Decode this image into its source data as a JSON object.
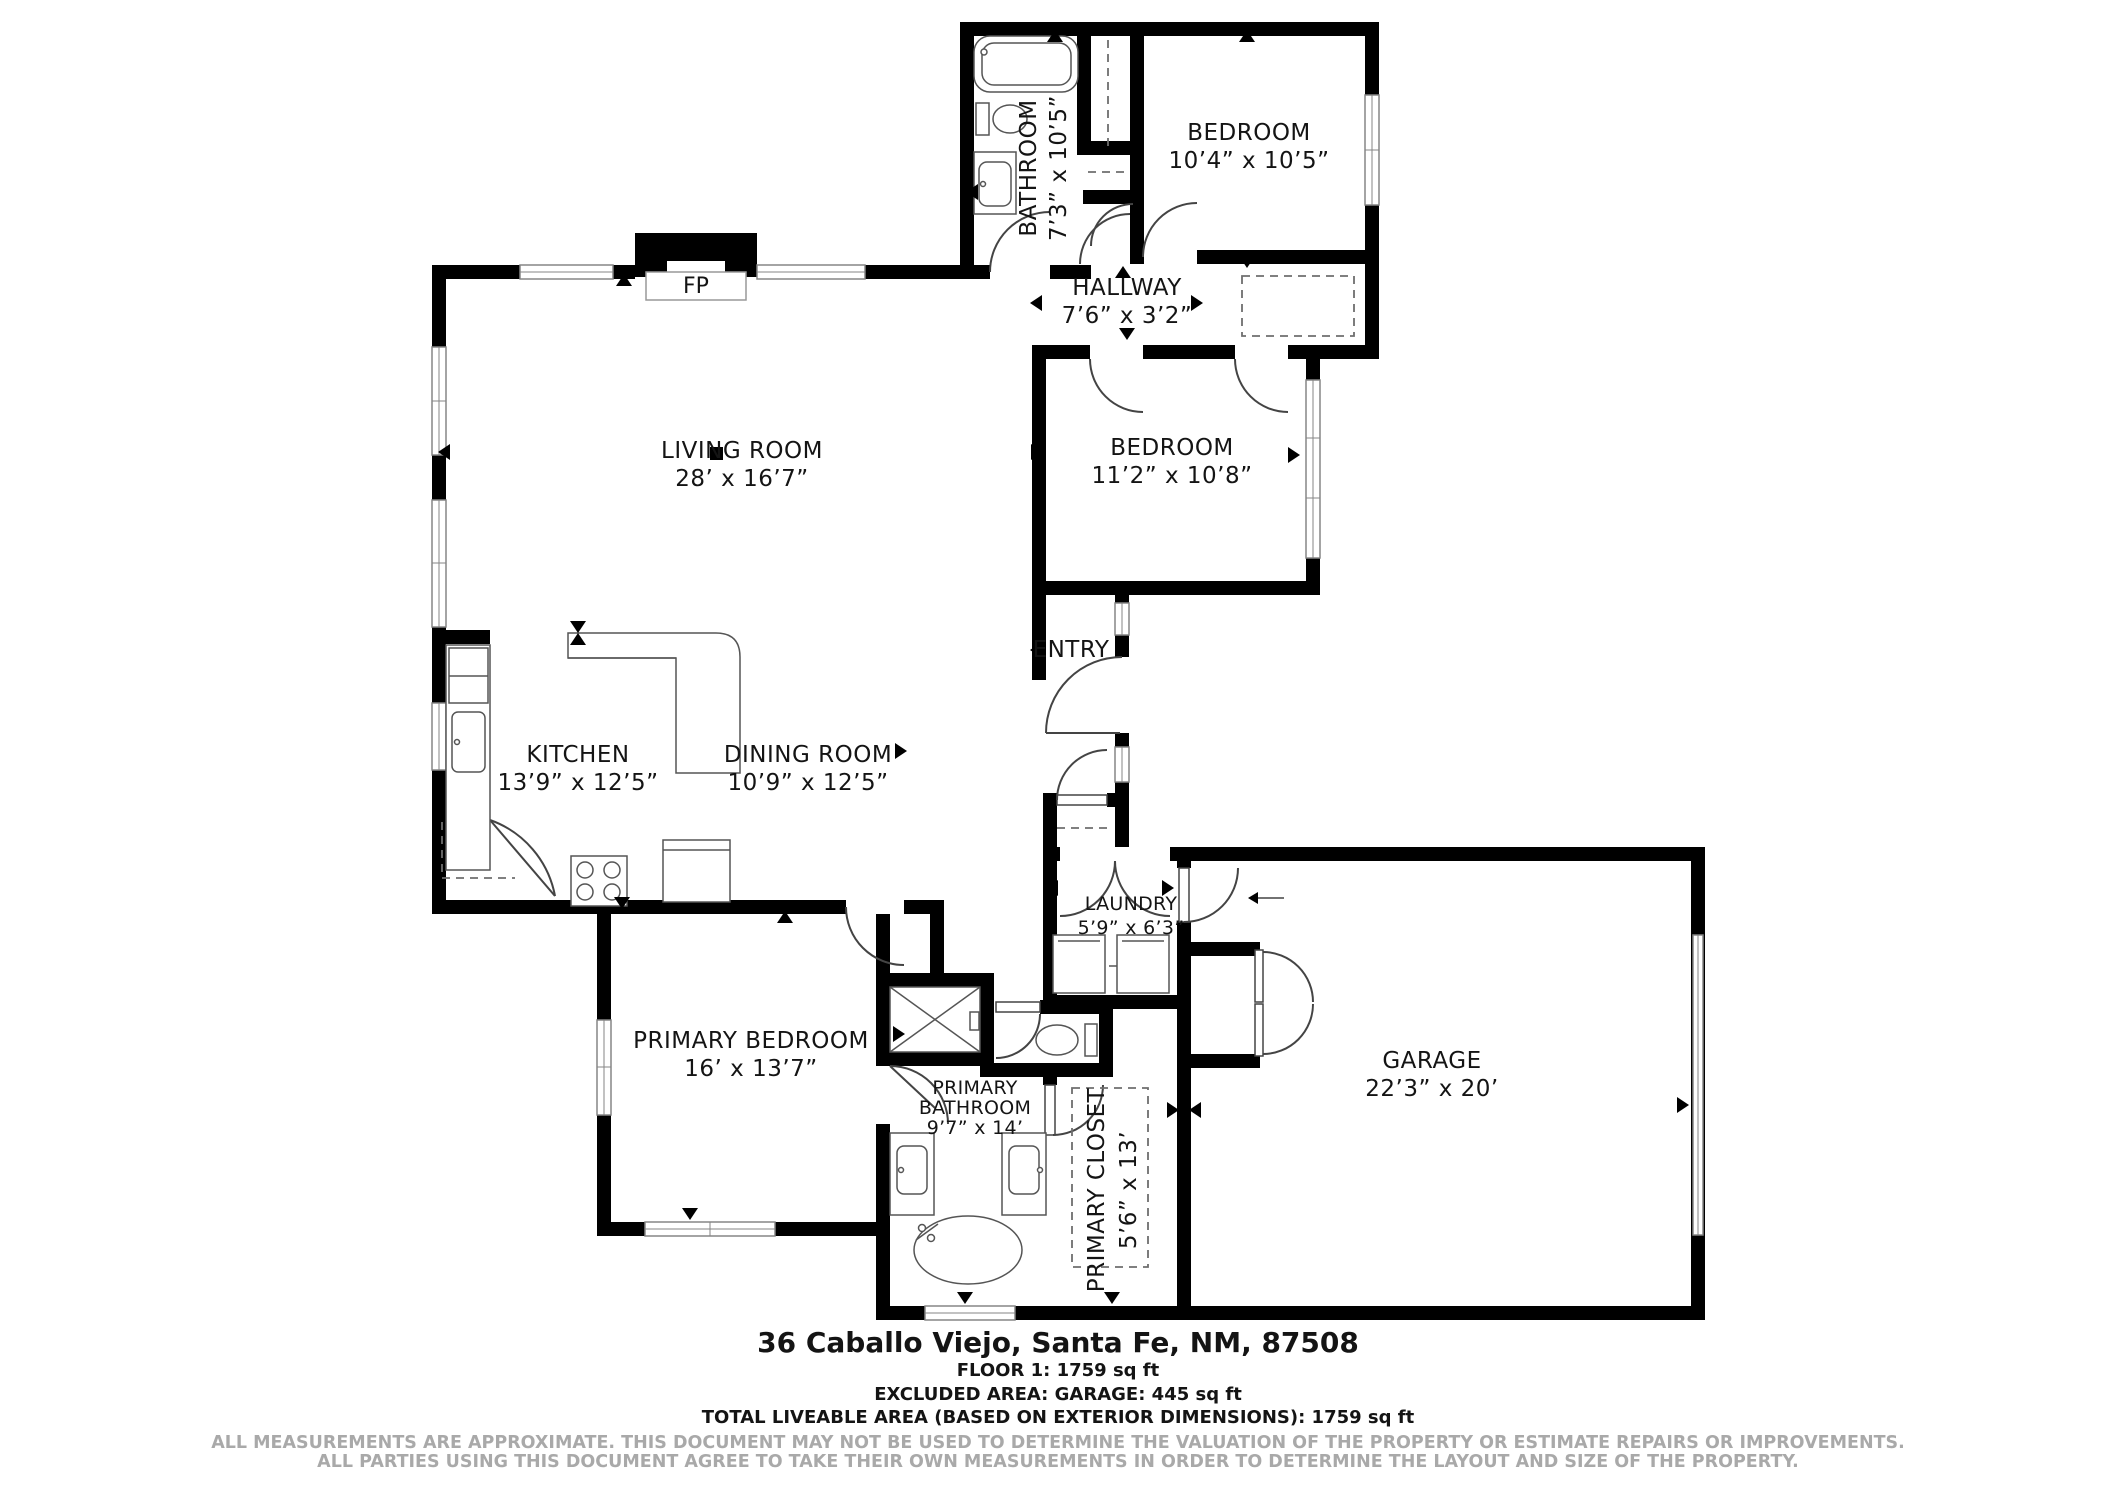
{
  "rooms": {
    "bathroom": {
      "name": "BATHROOM",
      "dims": "7’3” x 10’5”"
    },
    "bedroom_top": {
      "name": "BEDROOM",
      "dims": "10’4” x 10’5”"
    },
    "hallway": {
      "name": "HALLWAY",
      "dims": "7’6” x 3’2”"
    },
    "living_room": {
      "name": "LIVING ROOM",
      "dims": "28’ x 16’7”"
    },
    "bedroom_middle": {
      "name": "BEDROOM",
      "dims": "11’2” x 10’8”"
    },
    "entry": {
      "name": "ENTRY"
    },
    "kitchen": {
      "name": "KITCHEN",
      "dims": "13’9” x 12’5”"
    },
    "dining_room": {
      "name": "DINING ROOM",
      "dims": "10’9” x 12’5”"
    },
    "laundry": {
      "name": "LAUNDRY",
      "dims": "5’9” x 6’3”"
    },
    "primary_bedroom": {
      "name": "PRIMARY BEDROOM",
      "dims": "16’ x 13’7”"
    },
    "primary_bathroom": {
      "name_line1": "PRIMARY",
      "name_line2": "BATHROOM",
      "dims": "9’7” x 14’"
    },
    "primary_closet": {
      "name": "PRIMARY CLOSET",
      "dims": "5’6” x 13’"
    },
    "garage": {
      "name": "GARAGE",
      "dims": "22’3” x 20’"
    }
  },
  "labels": {
    "fireplace": "FP"
  },
  "footer": {
    "address": "36 Caballo Viejo, Santa Fe, NM, 87508",
    "floor_area": "FLOOR 1: 1759 sq ft",
    "excluded_area": "EXCLUDED AREA: GARAGE: 445 sq ft",
    "total_area": "TOTAL LIVEABLE AREA (BASED ON EXTERIOR DIMENSIONS): 1759 sq ft",
    "disclaimer_line1": "ALL MEASUREMENTS ARE APPROXIMATE. THIS DOCUMENT MAY NOT BE USED TO DETERMINE THE VALUATION OF THE PROPERTY OR ESTIMATE REPAIRS OR IMPROVEMENTS.",
    "disclaimer_line2": "ALL PARTIES USING THIS DOCUMENT AGREE TO TAKE THEIR OWN MEASUREMENTS IN ORDER TO DETERMINE THE LAYOUT AND SIZE OF THE PROPERTY."
  }
}
